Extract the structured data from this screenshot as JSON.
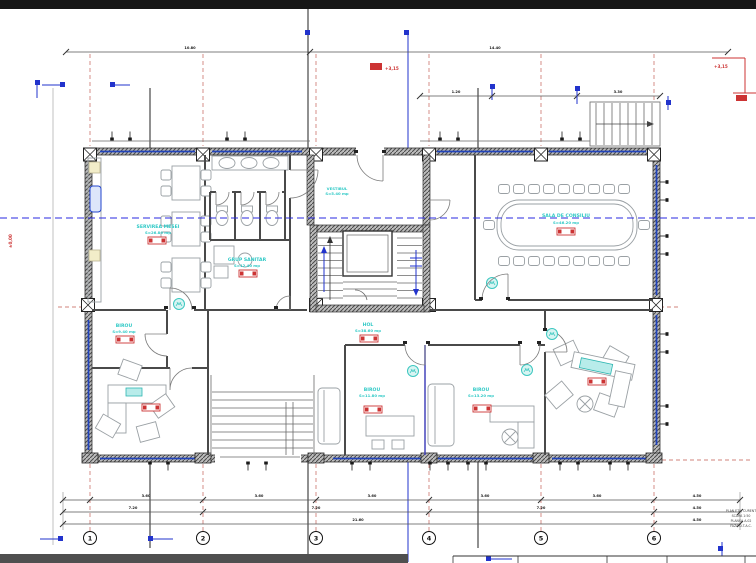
{
  "plan": {
    "rooms": [
      {
        "name": "SERVIREA MESEI",
        "area": "S=26.80 mp"
      },
      {
        "name": "GRUP SANITAR",
        "area": "S=12.40 mp"
      },
      {
        "name": "VESTIBUL",
        "area": "S=5.40 mp"
      },
      {
        "name": "SALA DE CONSILIU",
        "area": "S=46.20 mp"
      },
      {
        "name": "HOL",
        "area": "S=38.60 mp"
      },
      {
        "name": "BIROU",
        "area": "S=9.40 mp"
      },
      {
        "name": "BIROU",
        "area": "S=11.80 mp"
      },
      {
        "name": "BIROU",
        "area": "S=13.20 mp"
      }
    ],
    "grid_bubbles": [
      "1",
      "2",
      "3",
      "4",
      "5",
      "6"
    ],
    "dims": {
      "top": [
        "10.80",
        "14.40"
      ],
      "upper_right": [
        "1.20",
        "3.30"
      ],
      "row1": [
        "3.60",
        "3.60",
        "3.60",
        "3.60",
        "3.60",
        "4.50"
      ],
      "row2": [
        "7.20",
        "7.20",
        "7.20",
        "4.50"
      ],
      "row3": [
        "21.60",
        "4.50"
      ]
    },
    "levels": {
      "left": "±0,00",
      "top": "+3,15",
      "top_right": "+3,15"
    },
    "titleblock": [
      "PLAN ETAJ CURENT",
      "SCARA 1:50",
      "PLANSA A.02",
      "FAZA D.T.A.C."
    ],
    "colors": {
      "label_cyan": "#2fc9c6",
      "tag_red": "#cc3333",
      "section_blue": "#2233cc",
      "axis_red": "#c0594f",
      "wall_gray": "#3d3d3d"
    }
  }
}
